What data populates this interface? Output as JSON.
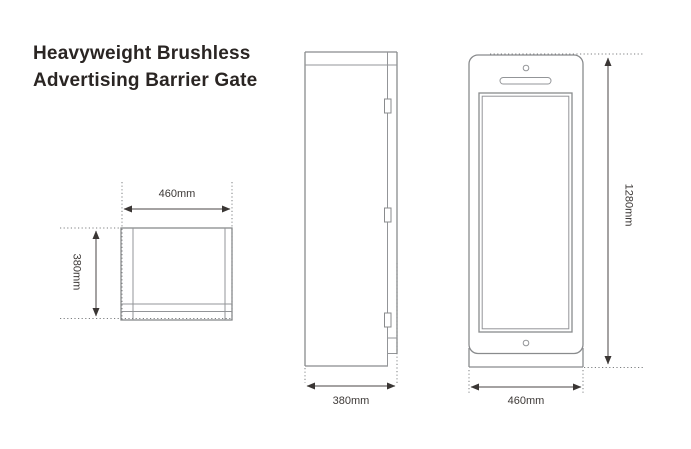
{
  "title": {
    "line1": "Heavyweight Brushless",
    "line2": "Advertising Barrier Gate"
  },
  "views": {
    "top_view": {
      "name": "top view",
      "width_label": "460mm",
      "depth_label": "380mm"
    },
    "side_view": {
      "name": "side view",
      "depth_label": "380mm"
    },
    "front_view": {
      "name": "front view",
      "height_label": "1280mm",
      "width_label": "460mm"
    }
  },
  "colors": {
    "background": "#ffffff",
    "outline": "#898b8d",
    "dimension_line": "#4a4644",
    "dimension_text": "#3d3937",
    "title_text": "#2a2523"
  }
}
